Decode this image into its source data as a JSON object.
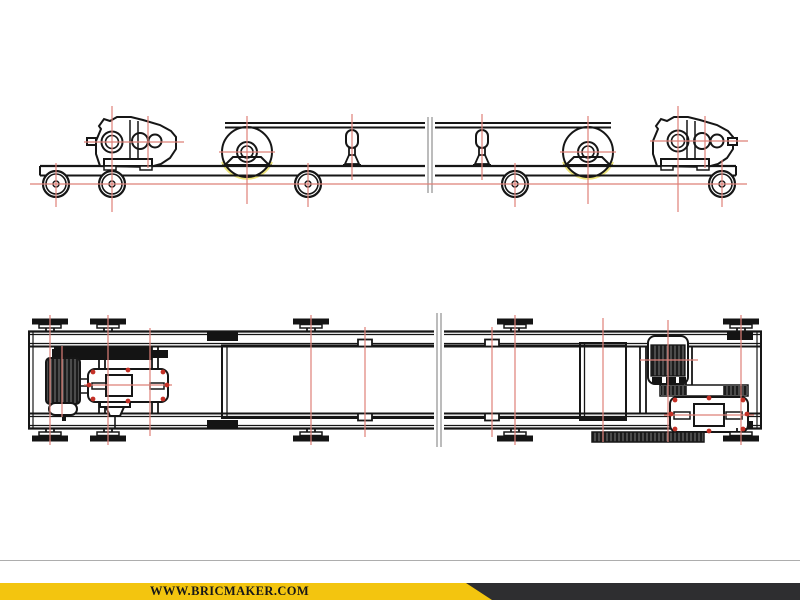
{
  "watermark_bar": {
    "text": "WWW.BRICMAKER.COM",
    "yellow": "#f3c50f",
    "dark": "#2e2e30",
    "text_color": "#181818",
    "hairline_color": "#adadad"
  },
  "drawing": {
    "subject": "belt-conveyor-two-view-cad-drawing",
    "colors": {
      "line": "#161616",
      "centerline": "#de8078",
      "accent_red": "#c43127",
      "belt_wrap_highlight": "#ece47a",
      "break_line": "#a6a6a6"
    },
    "side_elevation": {
      "wheel_positions_x": [
        56,
        112,
        308,
        515,
        722
      ],
      "wheel_center_y": 184,
      "pulley_positions_x": [
        247,
        588
      ],
      "pulley_center_y": 152,
      "support_positions_x": [
        352,
        482
      ]
    },
    "plan": {
      "wheel_positions_x": [
        50,
        108,
        311,
        515,
        741
      ],
      "roller_positions_x": [
        365,
        492
      ]
    },
    "centerlines": {
      "top_long_horizontal": {
        "y": 184,
        "x1": 30,
        "x2": 747
      },
      "top_vertical": [
        {
          "x": 56,
          "y1": 163,
          "y2": 207
        },
        {
          "x": 112,
          "y1": 106,
          "y2": 212
        },
        {
          "x": 148,
          "y1": 116,
          "y2": 168
        },
        {
          "x": 247,
          "y1": 116,
          "y2": 204
        },
        {
          "x": 308,
          "y1": 163,
          "y2": 207
        },
        {
          "x": 352,
          "y1": 114,
          "y2": 180
        },
        {
          "x": 482,
          "y1": 114,
          "y2": 180
        },
        {
          "x": 515,
          "y1": 163,
          "y2": 207
        },
        {
          "x": 588,
          "y1": 116,
          "y2": 204
        },
        {
          "x": 678,
          "y1": 106,
          "y2": 212
        },
        {
          "x": 705,
          "y1": 116,
          "y2": 168
        },
        {
          "x": 722,
          "y1": 160,
          "y2": 207
        }
      ],
      "top_horizontal": [
        {
          "y": 142,
          "x1": 84,
          "x2": 184
        },
        {
          "y": 141,
          "x1": 650,
          "x2": 748
        },
        {
          "y": 152,
          "x1": 219,
          "x2": 275
        },
        {
          "y": 152,
          "x1": 560,
          "x2": 616
        }
      ],
      "plan_vertical": [
        {
          "x": 50,
          "y1": 315,
          "y2": 445
        },
        {
          "x": 108,
          "y1": 315,
          "y2": 445
        },
        {
          "x": 311,
          "y1": 315,
          "y2": 445
        },
        {
          "x": 515,
          "y1": 315,
          "y2": 445
        },
        {
          "x": 741,
          "y1": 315,
          "y2": 445
        },
        {
          "x": 365,
          "y1": 327,
          "y2": 437
        },
        {
          "x": 492,
          "y1": 327,
          "y2": 437
        },
        {
          "x": 603,
          "y1": 318,
          "y2": 442
        },
        {
          "x": 62,
          "y1": 346,
          "y2": 417
        },
        {
          "x": 150,
          "y1": 328,
          "y2": 436
        },
        {
          "x": 668,
          "y1": 320,
          "y2": 442
        }
      ],
      "plan_horizontal": [
        {
          "y": 385,
          "x1": 84,
          "x2": 172
        },
        {
          "y": 360,
          "x1": 640,
          "x2": 698
        },
        {
          "y": 415,
          "x1": 664,
          "x2": 754
        }
      ]
    },
    "red_dots": [
      [
        93,
        372
      ],
      [
        163,
        372
      ],
      [
        93,
        399
      ],
      [
        163,
        399
      ],
      [
        128,
        370
      ],
      [
        128,
        401
      ],
      [
        89,
        385
      ],
      [
        167,
        385
      ],
      [
        675,
        400
      ],
      [
        743,
        400
      ],
      [
        675,
        429
      ],
      [
        743,
        429
      ],
      [
        709,
        398
      ],
      [
        709,
        431
      ],
      [
        671,
        414
      ],
      [
        747,
        414
      ]
    ]
  }
}
